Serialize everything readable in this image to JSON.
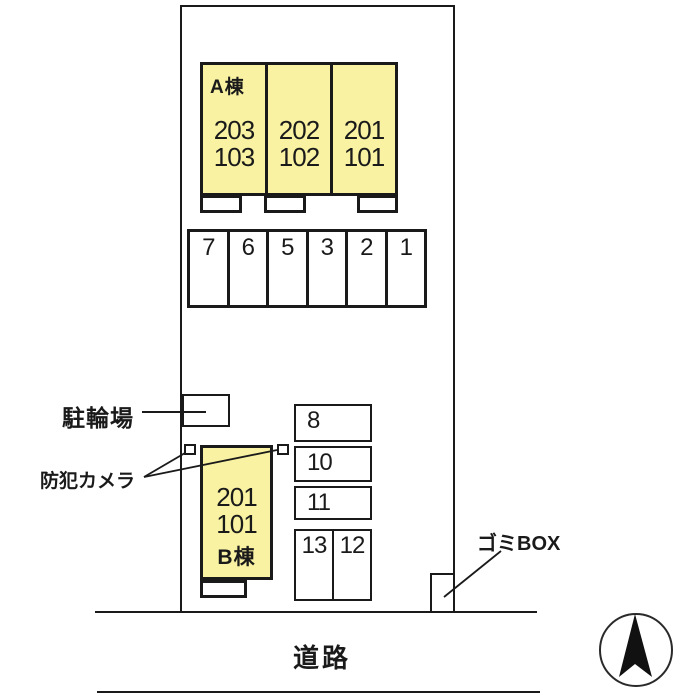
{
  "diagram": {
    "building_a": {
      "label": "A棟",
      "units": [
        {
          "upper": "203",
          "lower": "103"
        },
        {
          "upper": "202",
          "lower": "102"
        },
        {
          "upper": "201",
          "lower": "101"
        }
      ]
    },
    "building_b": {
      "label": "B棟",
      "upper": "201",
      "lower": "101"
    },
    "parking_top": {
      "spaces": [
        "7",
        "6",
        "5",
        "3",
        "2",
        "1"
      ]
    },
    "parking_right": {
      "spaces": [
        "8",
        "10",
        "11"
      ]
    },
    "parking_bottom": {
      "spaces": [
        "13",
        "12"
      ]
    },
    "bicycle_label": "駐輪場",
    "camera_label": "防犯カメラ",
    "garbage_label": "ゴミBOX",
    "road_label": "道路",
    "colors": {
      "building_fill": "#F8F2A2",
      "line": "#1A1A1A"
    }
  }
}
